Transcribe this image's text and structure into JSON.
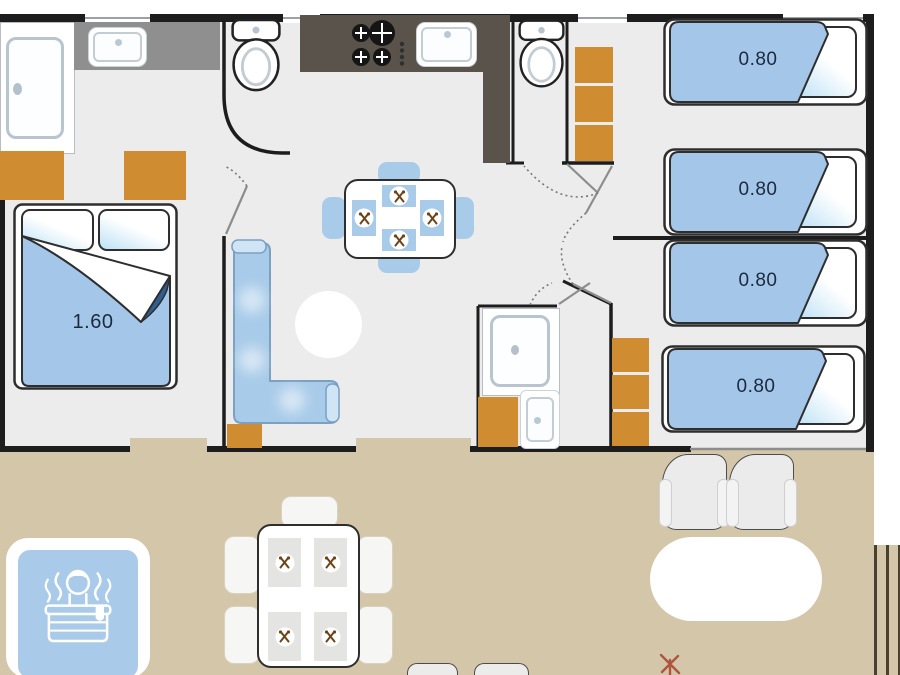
{
  "diagram": {
    "type": "mobile-home-floor-plan",
    "rooms": [
      "master-bedroom",
      "toilet-1",
      "kitchen",
      "toilet-2",
      "living-dining",
      "shower-room",
      "bedroom-twin-a",
      "bedroom-twin-b",
      "terrace"
    ]
  },
  "beds": {
    "double": {
      "label": "1.60"
    },
    "singles": [
      {
        "label": "0.80"
      },
      {
        "label": "0.80"
      },
      {
        "label": "0.80"
      },
      {
        "label": "0.80"
      }
    ]
  },
  "colors": {
    "wall": "#1d1d1d",
    "interior_floor": "#ececec",
    "terrace": "#d4c7a9",
    "furniture_blue": "#a8cbe9",
    "blanket_blue": "#a4c6e8",
    "cabinet_orange": "#cf8c31",
    "kitchen_counter_dark": "#59534b",
    "bathroom_counter_gray": "#8f8f8f",
    "label_navy": "#1c2a40",
    "blanket_fold_navy": "#2e5f90",
    "spa_blue": "#a9cbe9",
    "flower_mark": "#b0543f"
  },
  "icons": {
    "toilet-icon": "toilet seen from above",
    "shower-icon": "shower tray with drain dot",
    "sink-icon": "wash basin with tap dot",
    "stove-icon": "four burner hob with control knobs",
    "cutlery-icon": "crossed fork and spoon place setting",
    "spa-person-icon": "person relaxing in hot tub with steam",
    "flower-mark-icon": "small red sprig mark"
  }
}
